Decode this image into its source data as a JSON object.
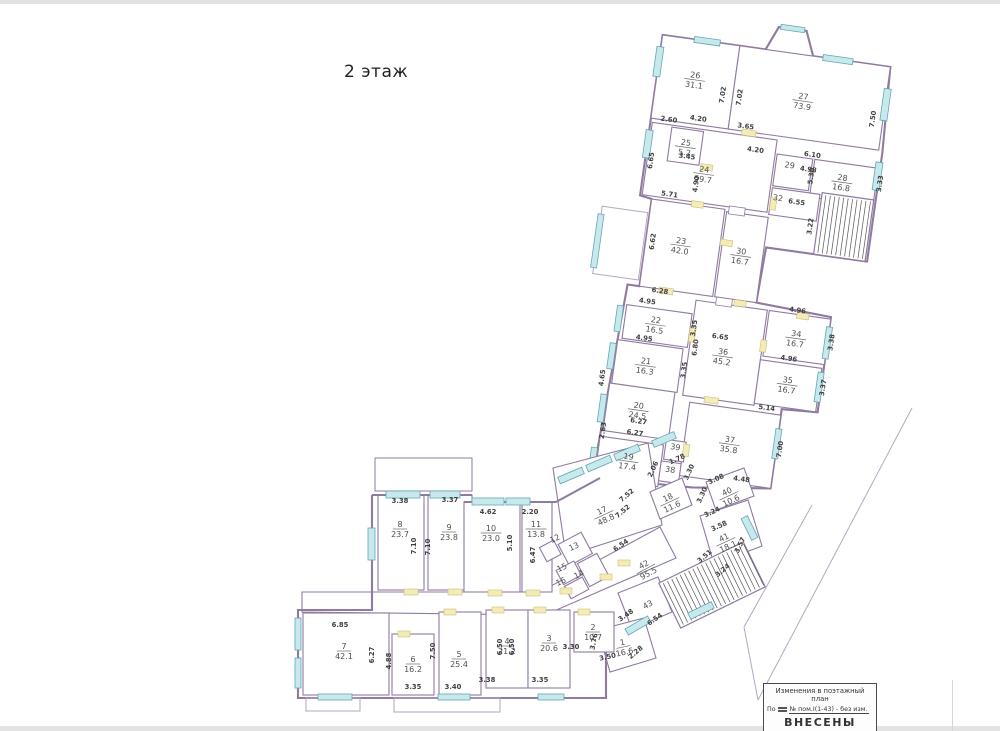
{
  "page": {
    "floor_title": "2 этаж"
  },
  "stamp": {
    "line1": "Изменения в поэтажный",
    "line2": "план",
    "line3_prefix": "По",
    "line3_value": "№  пом.I(1-43) - без изм.",
    "line4": "ВНЕСЕНЫ"
  },
  "plan": {
    "colors": {
      "wall": "#8f7aa0",
      "window": "#c9e8ec",
      "window_stroke": "#5fa8b8",
      "door": "#f3ecb6",
      "door_stroke": "#cbbf7a",
      "text": "#3f3f3f",
      "room_text": "#4f4f4f",
      "site_line": "#b7a6c2",
      "stair": "#565656"
    },
    "rooms": [
      {
        "n": "26",
        "area": "31.1",
        "g": "u",
        "x": 646,
        "y": 82,
        "rot": 0
      },
      {
        "n": "27",
        "area": "73.9",
        "g": "u",
        "x": 756,
        "y": 88,
        "rot": 0
      },
      {
        "n": "25",
        "area": "5.2",
        "g": "u",
        "x": 646,
        "y": 150,
        "rot": 0
      },
      {
        "n": "24",
        "area": "59.7",
        "g": "u",
        "x": 668,
        "y": 174,
        "rot": 0
      },
      {
        "n": "29",
        "area": "",
        "g": "u",
        "x": 752,
        "y": 158,
        "rot": 0
      },
      {
        "n": "28",
        "area": "16.8",
        "g": "u",
        "x": 806,
        "y": 163,
        "rot": 0
      },
      {
        "n": "32",
        "area": "",
        "g": "u",
        "x": 745,
        "y": 192,
        "rot": 0
      },
      {
        "n": "23",
        "area": "42.0",
        "g": "u",
        "x": 655,
        "y": 248,
        "rot": 0
      },
      {
        "n": "30",
        "area": "16.7",
        "g": "u",
        "x": 716,
        "y": 250,
        "rot": 0
      },
      {
        "n": "22",
        "area": "16.5",
        "g": "u",
        "x": 641,
        "y": 330,
        "rot": 0
      },
      {
        "n": "21",
        "area": "16.3",
        "g": "u",
        "x": 637,
        "y": 372,
        "rot": 0
      },
      {
        "n": "36",
        "area": "45.2",
        "g": "u",
        "x": 712,
        "y": 352,
        "rot": 0
      },
      {
        "n": "34",
        "area": "16.7",
        "g": "u",
        "x": 782,
        "y": 324,
        "rot": 0
      },
      {
        "n": "35",
        "area": "16.7",
        "g": "u",
        "x": 780,
        "y": 371,
        "rot": 0
      },
      {
        "n": "20",
        "area": "24.5",
        "g": "u",
        "x": 636,
        "y": 417,
        "rot": 0
      },
      {
        "n": "19",
        "area": "17.4",
        "g": "u",
        "x": 633,
        "y": 469,
        "rot": 0
      },
      {
        "n": "37",
        "area": "35.8",
        "g": "u",
        "x": 731,
        "y": 438,
        "rot": 0
      },
      {
        "n": "39",
        "area": "",
        "g": "u",
        "x": 678,
        "y": 453,
        "rot": 0
      },
      {
        "n": "38",
        "area": "",
        "g": "u",
        "x": 676,
        "y": 476,
        "rot": 0
      },
      {
        "n": "17",
        "area": "48.8",
        "g": "f",
        "x": 603,
        "y": 513,
        "rot": -25
      },
      {
        "n": "18",
        "area": "11.6",
        "g": "f",
        "x": 669,
        "y": 500,
        "rot": -25
      },
      {
        "n": "40",
        "area": "10.6",
        "g": "f",
        "x": 728,
        "y": 494,
        "rot": -25
      },
      {
        "n": "41",
        "area": "18.1",
        "g": "f",
        "x": 725,
        "y": 540,
        "rot": -25
      },
      {
        "n": "42",
        "area": "95.5",
        "g": "f",
        "x": 645,
        "y": 567,
        "rot": -28
      },
      {
        "n": "43",
        "area": "",
        "g": "f",
        "x": 649,
        "y": 607,
        "rot": -28
      },
      {
        "n": "12",
        "area": "",
        "g": "f",
        "x": 556,
        "y": 541,
        "rot": -25
      },
      {
        "n": "13",
        "area": "",
        "g": "f",
        "x": 575,
        "y": 549,
        "rot": -25
      },
      {
        "n": "15",
        "area": "",
        "g": "f",
        "x": 563,
        "y": 570,
        "rot": -25
      },
      {
        "n": "16",
        "area": "",
        "g": "f",
        "x": 562,
        "y": 584,
        "rot": -25
      },
      {
        "n": "14",
        "area": "",
        "g": "f",
        "x": 580,
        "y": 577,
        "rot": -25
      },
      {
        "n": "8",
        "area": "23.7",
        "g": "f",
        "x": 400,
        "y": 527,
        "rot": 0
      },
      {
        "n": "9",
        "area": "23.8",
        "g": "f",
        "x": 449,
        "y": 530,
        "rot": 0
      },
      {
        "n": "10",
        "area": "23.0",
        "g": "f",
        "x": 491,
        "y": 531,
        "rot": 0
      },
      {
        "n": "11",
        "area": "13.8",
        "g": "f",
        "x": 536,
        "y": 527,
        "rot": 0
      },
      {
        "n": "7",
        "area": "42.1",
        "g": "f",
        "x": 344,
        "y": 649,
        "rot": 0
      },
      {
        "n": "6",
        "area": "16.2",
        "g": "f",
        "x": 413,
        "y": 662,
        "rot": 0
      },
      {
        "n": "5",
        "area": "25.4",
        "g": "f",
        "x": 459,
        "y": 657,
        "rot": 0
      },
      {
        "n": "4",
        "area": "21.2",
        "g": "f",
        "x": 507,
        "y": 644,
        "rot": 0
      },
      {
        "n": "3",
        "area": "20.6",
        "g": "f",
        "x": 549,
        "y": 641,
        "rot": 0
      },
      {
        "n": "2",
        "area": "10.7",
        "g": "f",
        "x": 593,
        "y": 630,
        "rot": 0
      },
      {
        "n": "1",
        "area": "16.6",
        "g": "f",
        "x": 623,
        "y": 645,
        "rot": -12
      }
    ],
    "dims": [
      {
        "v": "2.60",
        "g": "u",
        "x": 626,
        "y": 129,
        "rot": 0
      },
      {
        "v": "4.20",
        "g": "u",
        "x": 655,
        "y": 124,
        "rot": 0
      },
      {
        "v": "3.65",
        "g": "u",
        "x": 703,
        "y": 125,
        "rot": 0
      },
      {
        "v": "4.20",
        "g": "u",
        "x": 716,
        "y": 147,
        "rot": 0
      },
      {
        "v": "6.10",
        "g": "u",
        "x": 773,
        "y": 144,
        "rot": 0
      },
      {
        "v": "4.98",
        "g": "u",
        "x": 771,
        "y": 159,
        "rot": 0
      },
      {
        "v": "7.02",
        "g": "u",
        "x": 678,
        "y": 95,
        "rot": -90
      },
      {
        "v": "7.02",
        "g": "u",
        "x": 695,
        "y": 95,
        "rot": -90
      },
      {
        "v": "7.50",
        "g": "u",
        "x": 830,
        "y": 98,
        "rot": -90
      },
      {
        "v": "6.65",
        "g": "u",
        "x": 616,
        "y": 170,
        "rot": -90
      },
      {
        "v": "3.45",
        "g": "u",
        "x": 649,
        "y": 163,
        "rot": 0
      },
      {
        "v": "4.90",
        "g": "u",
        "x": 664,
        "y": 187,
        "rot": -90
      },
      {
        "v": "5.71",
        "g": "u",
        "x": 637,
        "y": 203,
        "rot": 0
      },
      {
        "v": "5.30",
        "g": "u",
        "x": 777,
        "y": 163,
        "rot": -90
      },
      {
        "v": "3.33",
        "g": "u",
        "x": 846,
        "y": 161,
        "rot": -90
      },
      {
        "v": "3.22",
        "g": "u",
        "x": 783,
        "y": 213,
        "rot": -90
      },
      {
        "v": "6.55",
        "g": "u",
        "x": 764,
        "y": 193,
        "rot": 0
      },
      {
        "v": "6.62",
        "g": "u",
        "x": 629,
        "y": 250,
        "rot": -90
      },
      {
        "v": "6.28",
        "g": "u",
        "x": 641,
        "y": 300,
        "rot": 0
      },
      {
        "v": "4.95",
        "g": "u",
        "x": 630,
        "y": 312,
        "rot": 0
      },
      {
        "v": "3.35",
        "g": "u",
        "x": 682,
        "y": 330,
        "rot": -90
      },
      {
        "v": "4.95",
        "g": "u",
        "x": 632,
        "y": 349,
        "rot": 0
      },
      {
        "v": "3.35",
        "g": "u",
        "x": 678,
        "y": 373,
        "rot": -90
      },
      {
        "v": "6.80",
        "g": "u",
        "x": 686,
        "y": 349,
        "rot": -90
      },
      {
        "v": "6.65",
        "g": "u",
        "x": 707,
        "y": 337,
        "rot": 0
      },
      {
        "v": "4.96",
        "g": "u",
        "x": 780,
        "y": 300,
        "rot": 0
      },
      {
        "v": "3.38",
        "g": "u",
        "x": 820,
        "y": 325,
        "rot": -90
      },
      {
        "v": "4.96",
        "g": "u",
        "x": 778,
        "y": 349,
        "rot": 0
      },
      {
        "v": "3.37",
        "g": "u",
        "x": 818,
        "y": 371,
        "rot": -90
      },
      {
        "v": "5.14",
        "g": "u",
        "x": 763,
        "y": 401,
        "rot": 0
      },
      {
        "v": "4.65",
        "g": "u",
        "x": 598,
        "y": 392,
        "rot": -90
      },
      {
        "v": "6.27",
        "g": "u",
        "x": 638,
        "y": 432,
        "rot": 0
      },
      {
        "v": "6.27",
        "g": "u",
        "x": 636,
        "y": 444,
        "rot": 0
      },
      {
        "v": "2.63",
        "g": "u",
        "x": 606,
        "y": 444,
        "rot": -90
      },
      {
        "v": "7.00",
        "g": "u",
        "x": 784,
        "y": 438,
        "rot": -90
      },
      {
        "v": "4.48",
        "g": "u",
        "x": 748,
        "y": 475,
        "rot": 0
      },
      {
        "v": "3.38",
        "g": "f",
        "x": 400,
        "y": 503,
        "rot": 0
      },
      {
        "v": "3.37",
        "g": "f",
        "x": 450,
        "y": 502,
        "rot": 0
      },
      {
        "v": "4.62",
        "g": "f",
        "x": 488,
        "y": 514,
        "rot": 0
      },
      {
        "v": "2.20",
        "g": "f",
        "x": 530,
        "y": 514,
        "rot": 0
      },
      {
        "v": "7.10",
        "g": "f",
        "x": 416,
        "y": 546,
        "rot": -90
      },
      {
        "v": "7.10",
        "g": "f",
        "x": 430,
        "y": 547,
        "rot": -90
      },
      {
        "v": "5.10",
        "g": "f",
        "x": 512,
        "y": 543,
        "rot": -90
      },
      {
        "v": "6.47",
        "g": "f",
        "x": 535,
        "y": 555,
        "rot": -90
      },
      {
        "v": "6.85",
        "g": "f",
        "x": 340,
        "y": 627,
        "rot": 0
      },
      {
        "v": "6.27",
        "g": "f",
        "x": 374,
        "y": 655,
        "rot": -90
      },
      {
        "v": "4.88",
        "g": "f",
        "x": 391,
        "y": 661,
        "rot": -90
      },
      {
        "v": "3.35",
        "g": "f",
        "x": 413,
        "y": 689,
        "rot": 0
      },
      {
        "v": "7.50",
        "g": "f",
        "x": 435,
        "y": 651,
        "rot": -90
      },
      {
        "v": "3.40",
        "g": "f",
        "x": 453,
        "y": 689,
        "rot": 0
      },
      {
        "v": "3.38",
        "g": "f",
        "x": 487,
        "y": 682,
        "rot": 0
      },
      {
        "v": "6.50",
        "g": "f",
        "x": 502,
        "y": 647,
        "rot": -90
      },
      {
        "v": "6.50",
        "g": "f",
        "x": 514,
        "y": 647,
        "rot": -90
      },
      {
        "v": "3.35",
        "g": "f",
        "x": 540,
        "y": 682,
        "rot": 0
      },
      {
        "v": "3.30",
        "g": "f",
        "x": 571,
        "y": 649,
        "rot": 0
      },
      {
        "v": "3.76",
        "g": "f",
        "x": 596,
        "y": 642,
        "rot": -78
      },
      {
        "v": "3.50",
        "g": "f",
        "x": 608,
        "y": 659,
        "rot": -12
      },
      {
        "v": "2.28",
        "g": "f",
        "x": 637,
        "y": 654,
        "rot": -40
      },
      {
        "v": "3.48",
        "g": "f",
        "x": 627,
        "y": 617,
        "rot": -35
      },
      {
        "v": "6.54",
        "g": "f",
        "x": 622,
        "y": 547,
        "rot": -35
      },
      {
        "v": "6.54",
        "g": "f",
        "x": 656,
        "y": 621,
        "rot": -35
      },
      {
        "v": "7.52",
        "g": "f",
        "x": 628,
        "y": 497,
        "rot": -40
      },
      {
        "v": "7.52",
        "g": "f",
        "x": 624,
        "y": 513,
        "rot": -40
      },
      {
        "v": "2.06",
        "g": "f",
        "x": 655,
        "y": 470,
        "rot": -65
      },
      {
        "v": "1.78",
        "g": "f",
        "x": 678,
        "y": 461,
        "rot": -25
      },
      {
        "v": "3.30",
        "g": "f",
        "x": 691,
        "y": 473,
        "rot": -65
      },
      {
        "v": "3.08",
        "g": "f",
        "x": 717,
        "y": 481,
        "rot": -25
      },
      {
        "v": "3.30",
        "g": "f",
        "x": 704,
        "y": 496,
        "rot": -65
      },
      {
        "v": "3.24",
        "g": "f",
        "x": 713,
        "y": 514,
        "rot": -25
      },
      {
        "v": "3.58",
        "g": "f",
        "x": 720,
        "y": 528,
        "rot": -25
      },
      {
        "v": "3.57",
        "g": "f",
        "x": 742,
        "y": 546,
        "rot": -65
      },
      {
        "v": "3.51",
        "g": "f",
        "x": 706,
        "y": 558,
        "rot": -40
      },
      {
        "v": "3.24",
        "g": "f",
        "x": 724,
        "y": 572,
        "rot": -40
      }
    ]
  }
}
